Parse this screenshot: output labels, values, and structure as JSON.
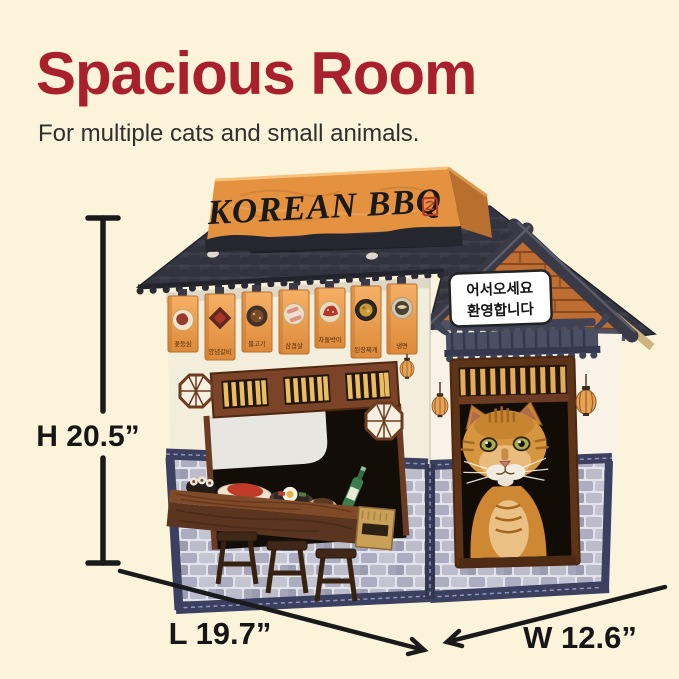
{
  "colors": {
    "background": "#FBF4DB",
    "title_red": "#A8202C",
    "banner_orange": "#E9A050",
    "roof_charcoal": "#3A3A46",
    "sign_orange": "#E49140",
    "stone_grey": "#ADADC1",
    "trim_navy": "#3C4060"
  },
  "header": {
    "title": "Spacious Room",
    "subtitle": "For multiple cats and small animals."
  },
  "house": {
    "roof_sign_text": "KOREAN BBQ",
    "welcome_sign": {
      "line1": "어서오세요",
      "line2": "환영합니다"
    },
    "menu_banners": [
      {
        "label": "꽃등심"
      },
      {
        "label": "양념갈비"
      },
      {
        "label": "불고기"
      },
      {
        "label": "삼겹살"
      },
      {
        "label": "차돌박이"
      },
      {
        "label": "된장찌개"
      },
      {
        "label": "냉면"
      }
    ]
  },
  "dimensions": {
    "height_label": "H 20.5”",
    "length_label": "L 19.7”",
    "width_label": "W 12.6”"
  }
}
